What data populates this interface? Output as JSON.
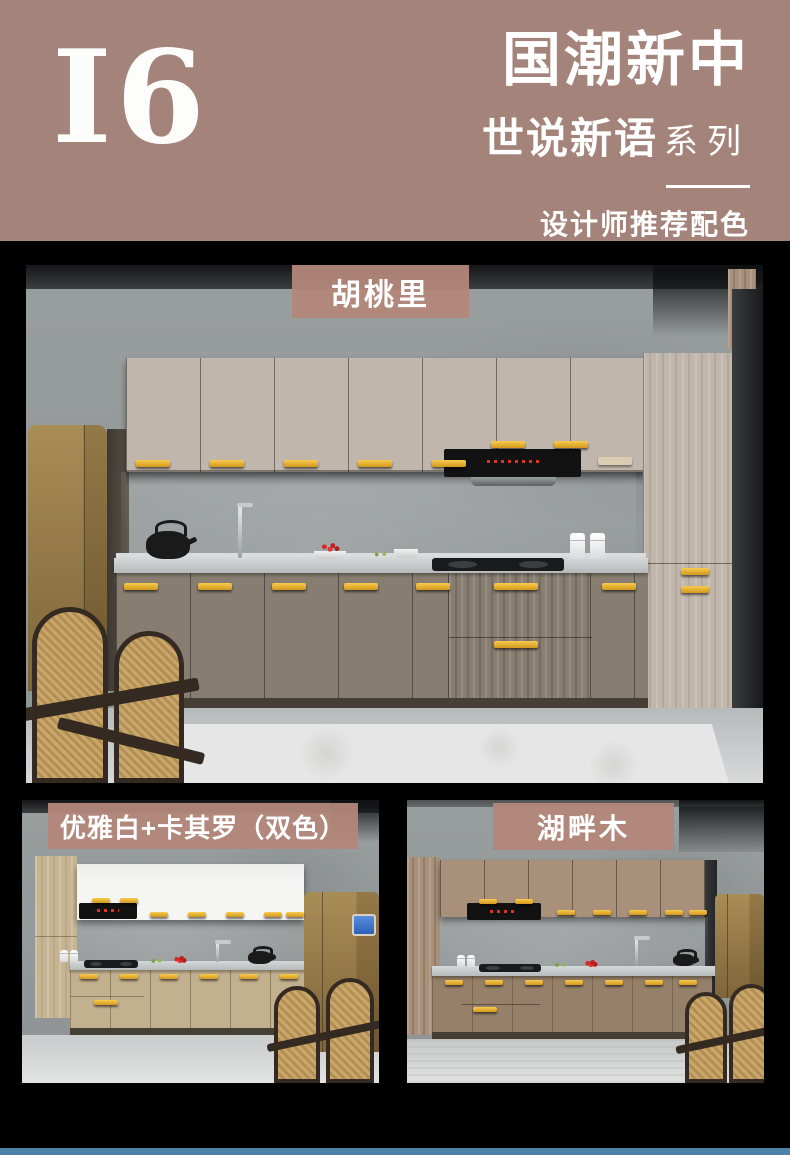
{
  "header": {
    "logo": "I6",
    "title": "国潮新中",
    "series": "世说新语",
    "series_suffix": "系列",
    "tagline": "设计师推荐配色"
  },
  "colorways": {
    "main": "胡桃里",
    "bottom_left": "优雅白+卡其罗（双色）",
    "bottom_right": "湖畔木"
  },
  "colors": {
    "header_bg": "#a3837a",
    "label_bg": "#b2877a",
    "section_bg": "#000000",
    "footer_bar": "#4d81a8",
    "handle_gold": "#e8ae34",
    "fridge_champagne": "#c2ae83",
    "text": "#ffffff"
  }
}
